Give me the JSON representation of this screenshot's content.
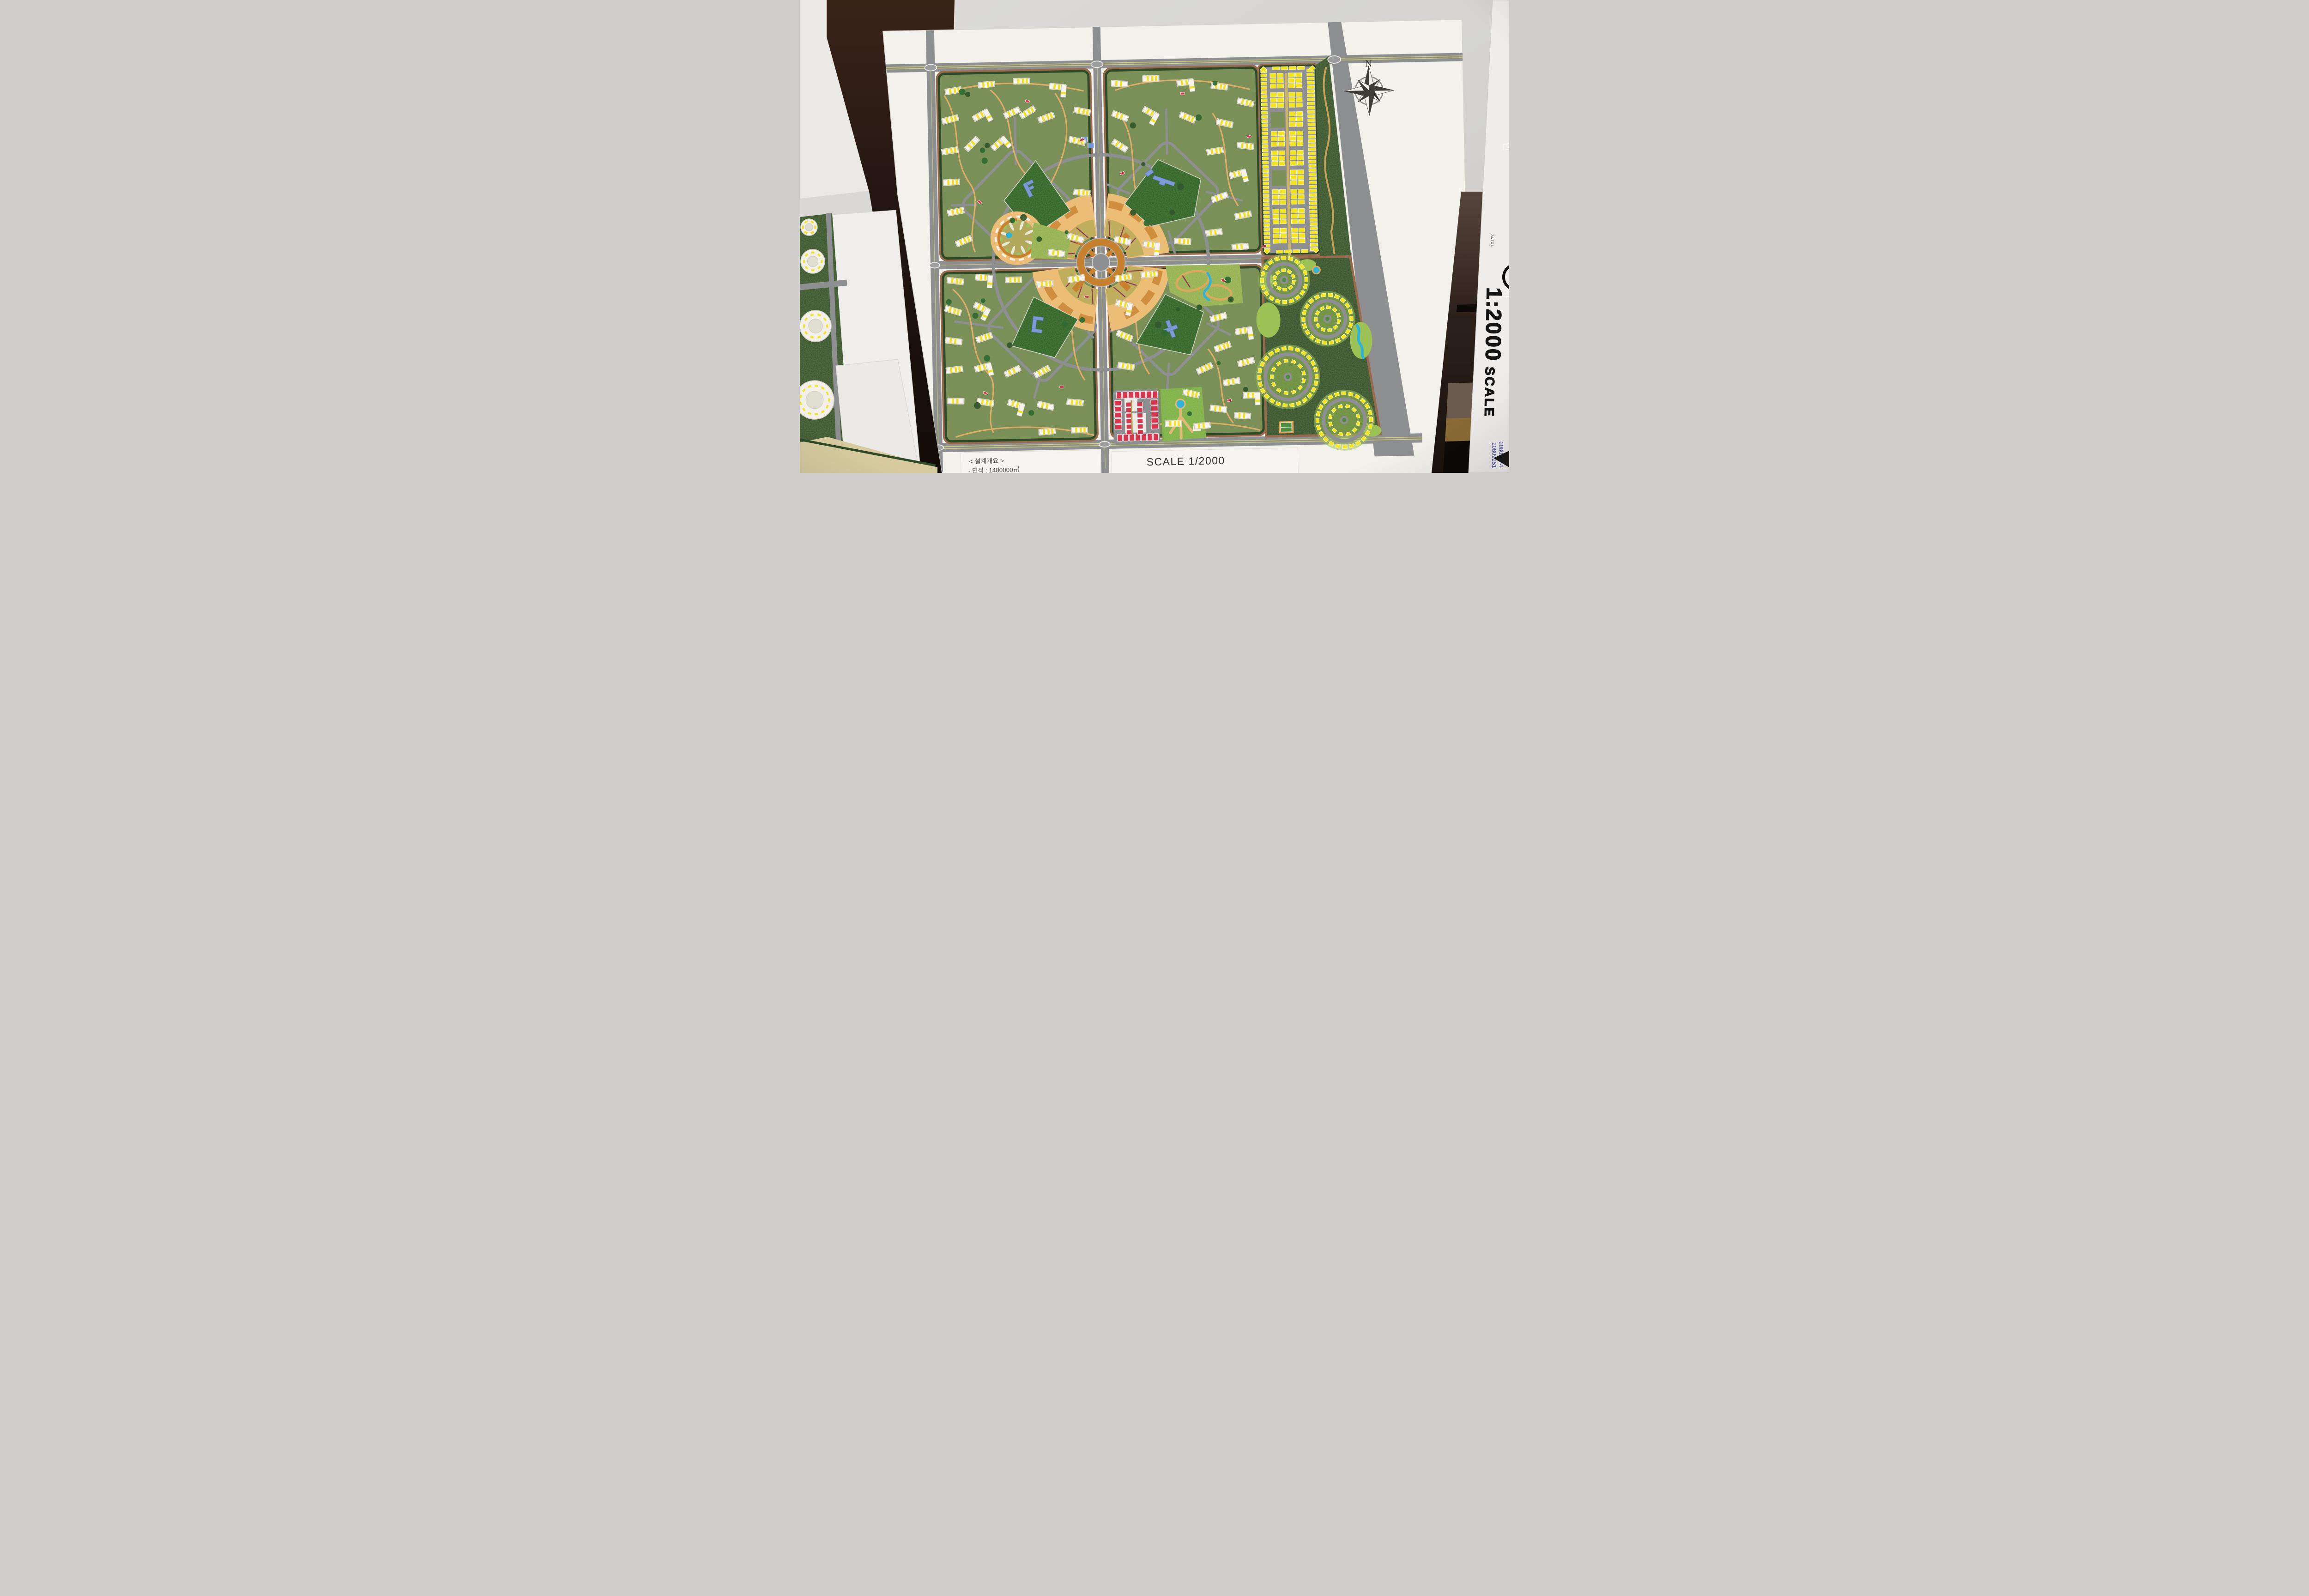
{
  "scene": {
    "type": "photograph of an architectural scale-model presentation board",
    "subject": "residential new-town master plan model with four quadrants, central circular plaza and east park strip"
  },
  "board": {
    "north_label": "N",
    "scale_panel": {
      "title": "SCALE  1/2000",
      "bar_ticks": [
        "0",
        "100",
        "250",
        "500M"
      ]
    },
    "design_overview": {
      "heading": "< 설계개요 >",
      "area_line": "- 면적 : 1480000㎡",
      "population_line": "- 총 인구 : 17,571 명"
    }
  },
  "handwriting": {
    "marker_note_part1": "1:2000",
    "marker_note_part2": " SCALE",
    "pen_ids": [
      "20809144",
      "20809251"
    ],
    "faint_wall_character": "한",
    "fine_print": "AUTOB"
  },
  "colors": {
    "wall": "#d6d4d1",
    "board_white": "#f3f1ec",
    "road_gray": "#8d8f91",
    "ground_green": "#7f925a",
    "hedge_green": "#2e4a26",
    "park_green": "#156018",
    "lawn_green": "#a9c35b",
    "plaza_orange": "#ecbd77",
    "plaza_tile": "#cf8f3f",
    "plaza_ring": "#c8822f",
    "house_yellow": "#f2e41f",
    "building_white": "#f6f4ec",
    "stripe_yellow": "#f2e025",
    "civic_blue": "#7d9ad6",
    "market_red": "#d4374e",
    "pond_blue": "#2fb4d9",
    "path_tan": "#e2af68",
    "sand": "#dbcfa2",
    "furniture_dark": "#231712",
    "center_line_yellow": "#d8d66a"
  }
}
